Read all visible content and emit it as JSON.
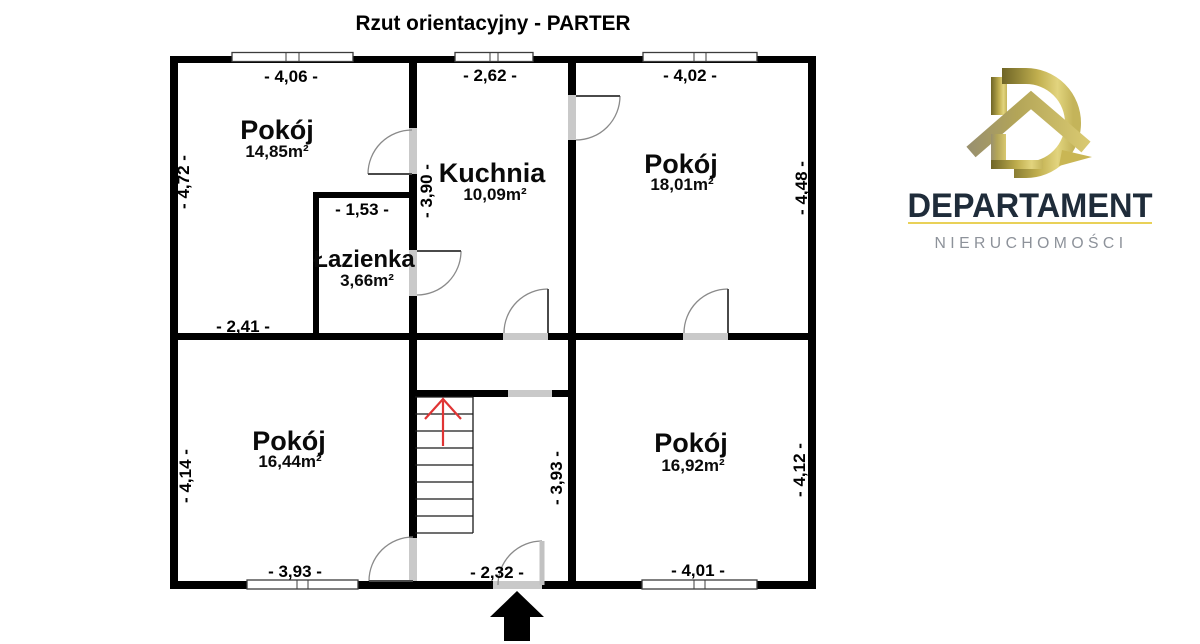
{
  "title": "Rzut orientacyjny - PARTER",
  "plan": {
    "rooms": [
      {
        "name": "Pokój",
        "area": "14,85m²"
      },
      {
        "name": "Kuchnia",
        "area": "10,09m²"
      },
      {
        "name": "Pokój",
        "area": "18,01m²"
      },
      {
        "name": "Łazienka",
        "area": "3,66m²"
      },
      {
        "name": "Pokój",
        "area": "16,44m²"
      },
      {
        "name": "Pokój",
        "area": "16,92m²"
      }
    ],
    "dimensions": {
      "top_left": "- 4,06 -",
      "top_middle": "- 2,62 -",
      "top_right": "- 4,02 -",
      "bathroom_width": "- 1,53 -",
      "room1_bottom": "- 2,41 -",
      "bottom_left": "- 3,93 -",
      "entrance_width": "- 2,32 -",
      "bottom_right": "- 4,01 -",
      "left_upper": "- 4,72 -",
      "kitchen_wall": "- 3,90 -",
      "right_upper": "- 4,48 -",
      "left_lower": "- 4,14 -",
      "hall_height": "- 3,93 -",
      "right_lower": "- 4,12 -"
    }
  },
  "logo": {
    "brand": "DEPARTAMENT",
    "subtitle": "NIERUCHOMOŚCI"
  },
  "colors": {
    "wall": "#000000",
    "opening": "#c9c9c9",
    "door_arc": "#8a8a8a",
    "stair_arrow": "#e03434",
    "brand_navy": "#1f2c3a",
    "brand_gray": "#8d929a",
    "brand_gold": "#cdbb52",
    "brand_underline": "#e9d158"
  }
}
